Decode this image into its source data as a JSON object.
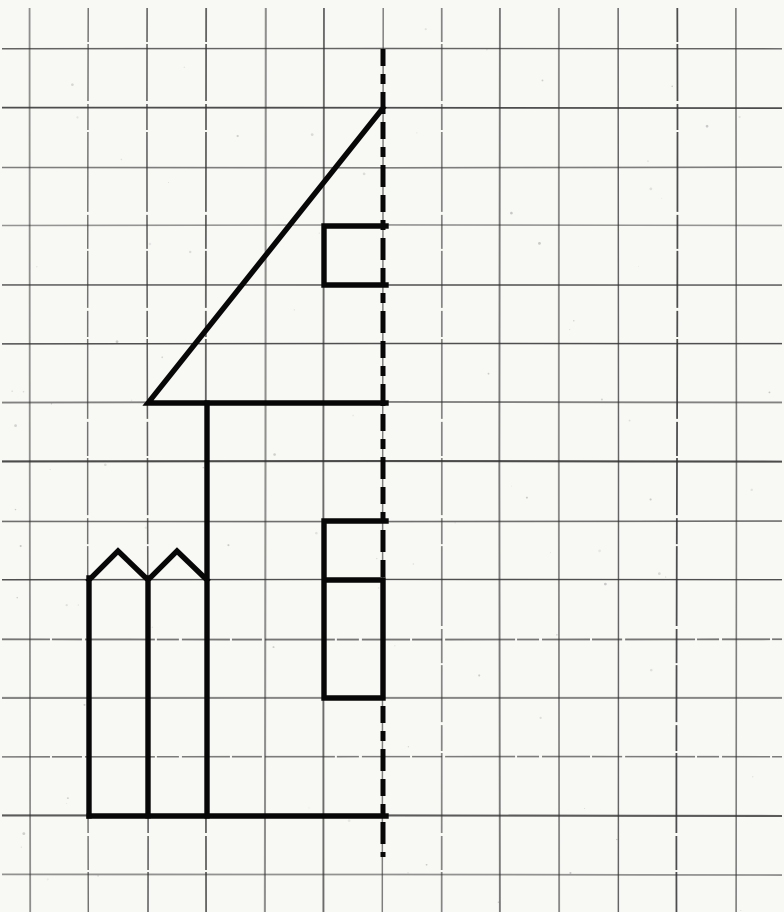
{
  "canvas": {
    "width": 784,
    "height": 912
  },
  "colors": {
    "paper": "#f8f8f5",
    "grid_line": "#333333",
    "ink": "#070707",
    "speckle": "#555555"
  },
  "grid": {
    "x_start": 30,
    "y_start": 49,
    "x_step": 58.8,
    "y_step": 59,
    "vertical_line_count": 13,
    "horizontal_line_count": 15,
    "vertical_span": [
      8,
      912
    ],
    "horizontal_span": [
      2,
      782
    ],
    "stroke_width": 1.4
  },
  "chart_data": {
    "type": "line",
    "title": "",
    "description_visible_content": "half-house symmetry drawing on squared paper, left half drawn, dashed mirror axis",
    "axis_of_symmetry": {
      "x": 383,
      "y1": 49,
      "y2": 857,
      "dash_pattern": [
        17,
        8,
        10,
        8,
        22,
        8
      ],
      "stroke_width": 5
    },
    "figure_stroke_width": 5.4,
    "polylines": [
      {
        "name": "roof-triangle",
        "points": [
          [
            383,
            108
          ],
          [
            148,
            403
          ],
          [
            386,
            403
          ]
        ]
      },
      {
        "name": "house-wall",
        "points": [
          [
            207,
            403
          ],
          [
            207,
            816
          ]
        ]
      },
      {
        "name": "upper-window",
        "points": [
          [
            386,
            226
          ],
          [
            324,
            226
          ],
          [
            324,
            285
          ],
          [
            386,
            285
          ]
        ]
      },
      {
        "name": "lower-window",
        "points": [
          [
            386,
            521
          ],
          [
            324,
            521
          ],
          [
            324,
            698
          ],
          [
            383,
            698
          ],
          [
            383,
            580
          ],
          [
            324,
            580
          ]
        ]
      },
      {
        "name": "fence-zigzag-top",
        "points": [
          [
            89,
            580
          ],
          [
            118,
            551
          ],
          [
            148,
            580
          ],
          [
            177,
            551
          ],
          [
            207,
            580
          ]
        ]
      },
      {
        "name": "fence-picket-left",
        "points": [
          [
            89,
            578
          ],
          [
            89,
            816
          ]
        ]
      },
      {
        "name": "fence-picket-middle",
        "points": [
          [
            148,
            578
          ],
          [
            148,
            816
          ]
        ]
      },
      {
        "name": "ground-line",
        "points": [
          [
            89,
            816
          ],
          [
            386,
            816
          ]
        ]
      }
    ]
  }
}
